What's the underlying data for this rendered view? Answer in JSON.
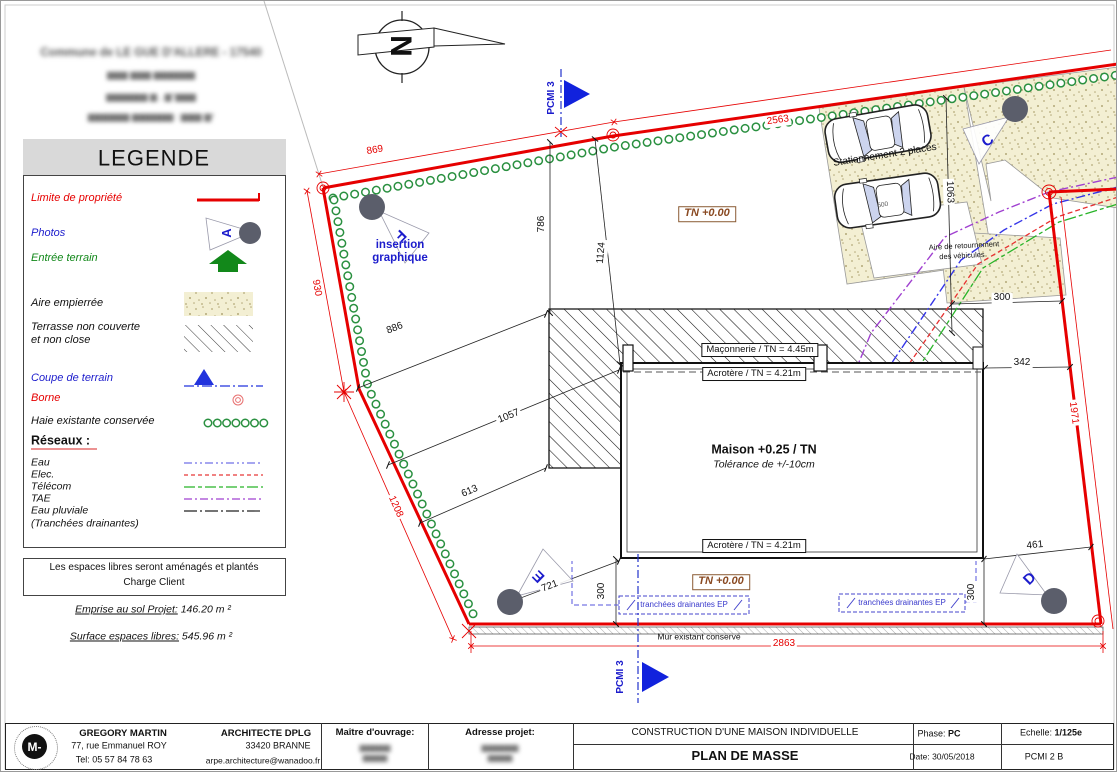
{
  "sheet_note": {
    "line1": "Commune de LE GUE D'ALLERE - 17540",
    "line2": "▆▆▆ ▆▆▆ ▆▆▆▆▆▆",
    "line3": "▆▆▆▆▆▆ ▆ , ▆°▆▆▆",
    "line4": "▆▆▆▆▆▆ ▆▆▆▆▆▆ : ▆▆▆ ▆²"
  },
  "north": {
    "letter": "N"
  },
  "legend": {
    "title": "LEGENDE",
    "items": {
      "limite": "Limite de propriété",
      "photos": "Photos",
      "entree": "Entrée terrain",
      "aire": "Aire empierrée",
      "terrasse1": "Terrasse non couverte",
      "terrasse2": "et non close",
      "coupe": "Coupe de terrain",
      "borne": "Borne",
      "haie": "Haie existante conservée",
      "reseaux": "Réseaux :",
      "eau": "Eau",
      "elec": "Elec.",
      "telecom": "Télécom",
      "tae": "TAE",
      "pluviale1": "Eau pluviale",
      "pluviale2": "(Tranchées drainantes)"
    }
  },
  "notes": {
    "line1": "Les espaces libres seront aménagés et plantés",
    "line2": "Charge Client",
    "emprise_label": "Emprise au sol Projet:",
    "emprise_value": " 146.20 m ²",
    "surface_label": "Surface espaces libres:",
    "surface_value": "  545.96 m ²"
  },
  "plan": {
    "pcmi_top": "PCMI 3",
    "pcmi_bottom": "PCMI 3",
    "insertion1": "insertion",
    "insertion2": "graphique",
    "stationnement": "Stationnement 2 places",
    "parking_dim": "500",
    "aire_ret1": "Aire de retournement",
    "aire_ret2": "des véhicules",
    "tn_top": "TN +0.00",
    "tn_bottom": "TN +0.00",
    "maconnerie": "Maçonnerie / TN = 4.45m",
    "acrotere_top": "Acrotère / TN = 4.21m",
    "acrotere_bottom": "Acrotère / TN = 4.21m",
    "maison": "Maison +0.25 / TN",
    "tolerance": "Tolérance de +/-10cm",
    "tranchees_left": "tranchées drainantes EP",
    "tranchees_right": "tranchées drainantes EP",
    "mur": "Mur existant conservé",
    "markers": {
      "a": "A",
      "c": "C",
      "d": "D",
      "e": "E",
      "f": "F"
    },
    "dims": {
      "d869": "869",
      "d930": "930",
      "d2563": "2563",
      "d1208": "1208",
      "d2863": "2863",
      "d1971": "1971",
      "d786": "786",
      "d1124": "1124",
      "d886": "886",
      "d1057": "1057",
      "d613": "613",
      "d721": "721",
      "d300_left": "300",
      "d300_right_top": "300",
      "d300_right_bottom": "300",
      "d342": "342",
      "d461": "461",
      "d1063": "1063"
    }
  },
  "titleblock": {
    "architect_name": "GREGORY MARTIN",
    "architect_addr": "77, rue Emmanuel ROY",
    "architect_tel": "Tel:  05 57 84 78 63",
    "architect_title": "ARCHITECTE DPLG",
    "architect_city": "33420 BRANNE",
    "architect_email": "arpe.architecture@wanadoo.fr",
    "maitre": "Maître d'ouvrage:",
    "maitre_lines": [
      "▆▆▆▆▆",
      "▆▆▆▆"
    ],
    "adresse": "Adresse projet:",
    "adresse_lines": [
      "▆▆▆▆▆▆",
      "▆▆▆▆"
    ],
    "project": "CONSTRUCTION D'UNE MAISON INDIVIDUELLE",
    "sheet": "PLAN DE MASSE",
    "phase_label": "Phase: ",
    "phase_value": "PC",
    "echelle_label": "Echelle:    ",
    "echelle_value": "1/125e",
    "date_label": "Date: ",
    "date_value": "30/05/2018",
    "ref": "PCMI 2 B",
    "logo_letter": "M-"
  }
}
